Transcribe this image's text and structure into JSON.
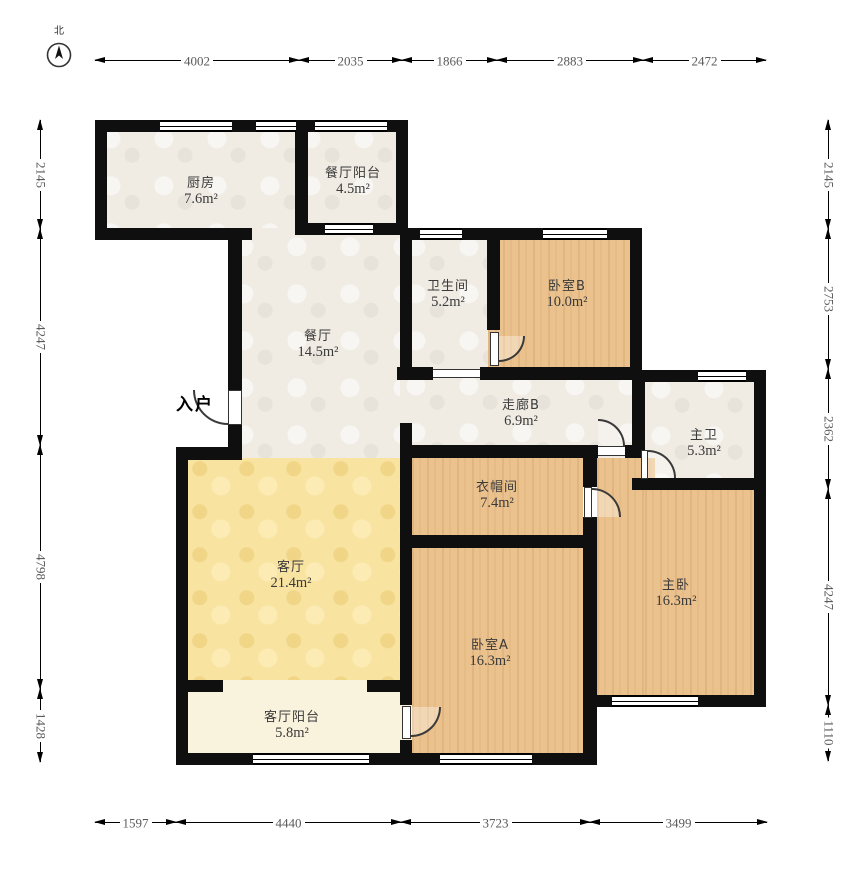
{
  "compass": {
    "north_label": "北"
  },
  "entry": {
    "label": "入户"
  },
  "rooms": [
    {
      "id": "kitchen",
      "name": "厨房",
      "area": "7.6m²"
    },
    {
      "id": "dining-balcony",
      "name": "餐厅阳台",
      "area": "4.5m²"
    },
    {
      "id": "dining",
      "name": "餐厅",
      "area": "14.5m²"
    },
    {
      "id": "bathroom",
      "name": "卫生间",
      "area": "5.2m²"
    },
    {
      "id": "bedroom-b",
      "name": "卧室B",
      "area": "10.0m²"
    },
    {
      "id": "corridor-b",
      "name": "走廊B",
      "area": "6.9m²"
    },
    {
      "id": "master-bath",
      "name": "主卫",
      "area": "5.3m²"
    },
    {
      "id": "cloakroom",
      "name": "衣帽间",
      "area": "7.4m²"
    },
    {
      "id": "living",
      "name": "客厅",
      "area": "21.4m²"
    },
    {
      "id": "master-bedroom",
      "name": "主卧",
      "area": "16.3m²"
    },
    {
      "id": "bedroom-a",
      "name": "卧室A",
      "area": "16.3m²"
    },
    {
      "id": "living-balcony",
      "name": "客厅阳台",
      "area": "5.8m²"
    }
  ],
  "dimensions": {
    "top": [
      "4002",
      "2035",
      "1866",
      "2883",
      "2472"
    ],
    "bottom": [
      "1597",
      "4440",
      "3723",
      "3499"
    ],
    "left": [
      "2145",
      "4247",
      "4798",
      "1428"
    ],
    "right": [
      "2145",
      "2753",
      "2362",
      "4247",
      "1110"
    ]
  },
  "colors": {
    "wall": "#0f0f0f",
    "wood": "#ebc28d",
    "living_yellow": "#f8e3a1",
    "greige": "#f0ece4",
    "balcony_cream": "#f9f2dc",
    "dim_text": "#5a5a5a"
  }
}
